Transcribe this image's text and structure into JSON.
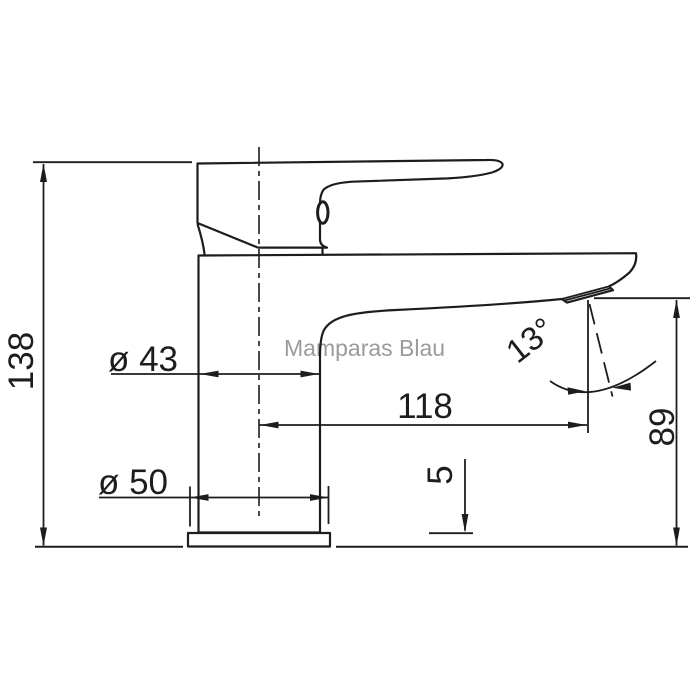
{
  "watermark": "Mamparas Blau",
  "dimensions": {
    "total_height": "138",
    "body_diameter": "ø 43",
    "base_diameter": "ø 50",
    "spout_reach": "118",
    "outlet_height": "89",
    "base_plate_thickness": "5",
    "handle_angle": "13°"
  },
  "colors": {
    "line": "#1d1d1d",
    "watermark": "#9b9b9b",
    "background": "#ffffff"
  }
}
